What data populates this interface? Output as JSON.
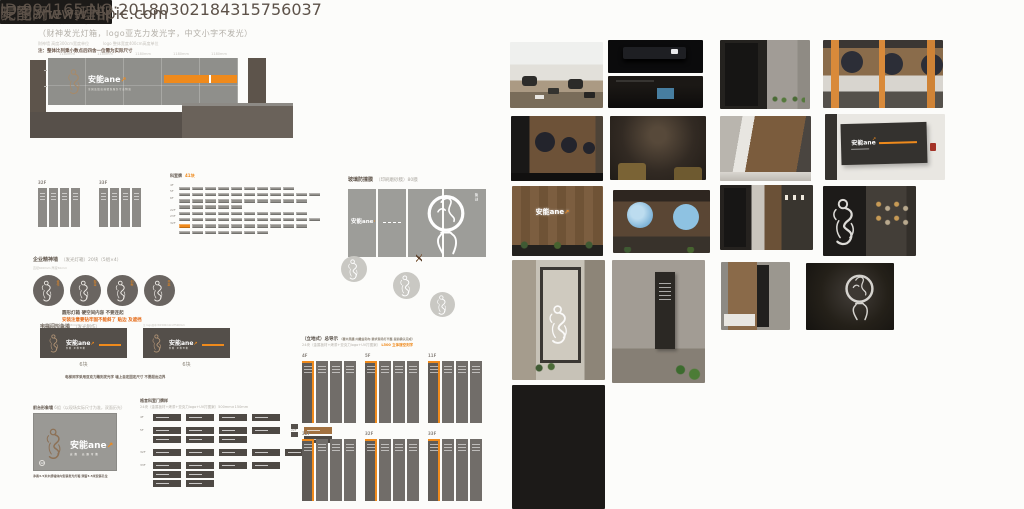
{
  "theme": {
    "accent": "#ef8a1c",
    "ink": "#5d5249",
    "page_bg": "#fcfcfa"
  },
  "watermarks": {
    "site_logo": "昵图网",
    "site_url": "www.nipic.com",
    "id_line": "ID:994165 NO:20180302184315756037"
  },
  "header": {
    "title": "33层形象墙",
    "count": "1组",
    "subtitle": "（财神发光灯箱，logo亚克力发光字，中文小字不发光）",
    "spec_left": "财神墙 高度300cm宽度单位",
    "spec_right": "logo 整体宽度400cm高度单位",
    "note": "注：整体比列乘小数点后四舍一位需为实际尺寸"
  },
  "elevation": {
    "dims": [
      "1180mm",
      "1180mm",
      "1180mm",
      "1180mm",
      "1180mm"
    ],
    "logo": "安能ane",
    "arrow": "↗",
    "logo_sub": "全国连锁高端精准服务专业物流"
  },
  "floor_banner_sets": [
    {
      "label": "32F"
    },
    {
      "label": "33F"
    }
  ],
  "room_table": {
    "title": "科室牌",
    "badge": "41块",
    "rows": [
      {
        "label": "4F",
        "chips": 9
      },
      {
        "label": "5F",
        "chips": 11
      },
      {
        "label": "6F",
        "chips": 10
      },
      {
        "label": "",
        "chips": 5
      },
      {
        "label": "22F",
        "chips": 10
      },
      {
        "label": "23F",
        "chips": 11
      },
      {
        "label": "32F",
        "chips": 10,
        "orange_first": true
      },
      {
        "label": "",
        "chips": 7
      }
    ]
  },
  "spirit_wall": {
    "title": "企业精神墙",
    "spec": "（发光灯箱）20块（5组×4）",
    "sub": "直径600mm 厚度50mm",
    "circles": [
      {
        "label": "合作"
      },
      {
        "label": "担当"
      },
      {
        "label": "创新"
      },
      {
        "label": "共赢"
      }
    ],
    "caption": "圆形灯箱 硬空间内容 不要连起",
    "warning": "安装注意要钻牢固不能斜了 贴边 及遮挡"
  },
  "elevator_wall": {
    "title": "电梯间形象墙",
    "spec": "（发光制作）",
    "dim_left": "W1500mm×H500mm 厚80mm",
    "dim_right": "注 logo居中 W1500mm×H500mm",
    "count_left": "6块",
    "count_right": "6块",
    "logo": "安能ane",
    "arrow": "↗",
    "logo_sub": "安能 无限可能",
    "note": "电梯间字采用亚克力雕刻发光字 墙上自定固定尺寸 不要超出边界"
  },
  "front_wall": {
    "title": "前台形象墙",
    "spec": "6组（以现场实际尺寸为准，双面历光）",
    "logo": "安能ane",
    "arrow": "↗",
    "logo_sub": "安能 无限可能",
    "badge": "12",
    "caption": "净高3.5米木质墙体内安装发光灯箱 预留3.5米安装孔位"
  },
  "door_plates": {
    "title": "格言科室门牌样",
    "spec": "24块（金属板材+烤漆+亚克力logo+UV打图案）500mm×150mm",
    "rows": [
      {
        "label": "4F",
        "cols": [
          {
            "stack": 1
          },
          {
            "stack": 1
          },
          {
            "stack": 1
          },
          {
            "stack": 1
          }
        ]
      },
      {
        "label": "5F",
        "cols": [
          {
            "stack": 2
          },
          {
            "stack": 2
          },
          {
            "stack": 2
          },
          {
            "stack": 1
          }
        ],
        "right_label": "22F",
        "right": [
          {
            "stack": 2,
            "orange_top": true
          }
        ]
      },
      {
        "label": "32F",
        "cols": [
          {
            "stack": 1
          },
          {
            "stack": 1
          },
          {
            "stack": 1
          },
          {
            "stack": 1
          },
          {
            "stack": 1
          }
        ]
      },
      {
        "label": "33F",
        "cols": [
          {
            "stack": 3
          },
          {
            "stack": 3
          },
          {
            "stack": 1
          },
          {
            "stack": 1
          }
        ]
      }
    ]
  },
  "glass_film": {
    "title": "玻璃防撞膜",
    "spec": "（印刷磨砂膜）80膜",
    "logo": "安能ane",
    "dot": "·",
    "vertical_label": "聚创"
  },
  "directory": {
    "title": "（立地式）总导示",
    "title_note": "（覆木黑膜 内雕金和布 要求现场打平整 提前确认完成）",
    "spec": "24块（金属板材+烤漆+亚克力logo+UV打图案）",
    "spec_accent": "L500 立体镂空刻字",
    "groups": [
      {
        "label": "4F"
      },
      {
        "label": "5F"
      },
      {
        "label": "11F"
      },
      {
        "label": "22F"
      },
      {
        "label": "32F"
      },
      {
        "label": "33F"
      }
    ]
  },
  "photos": {
    "logo": "安能ane",
    "arrow": "↗",
    "dept_sign": "组织绩效管理部"
  }
}
